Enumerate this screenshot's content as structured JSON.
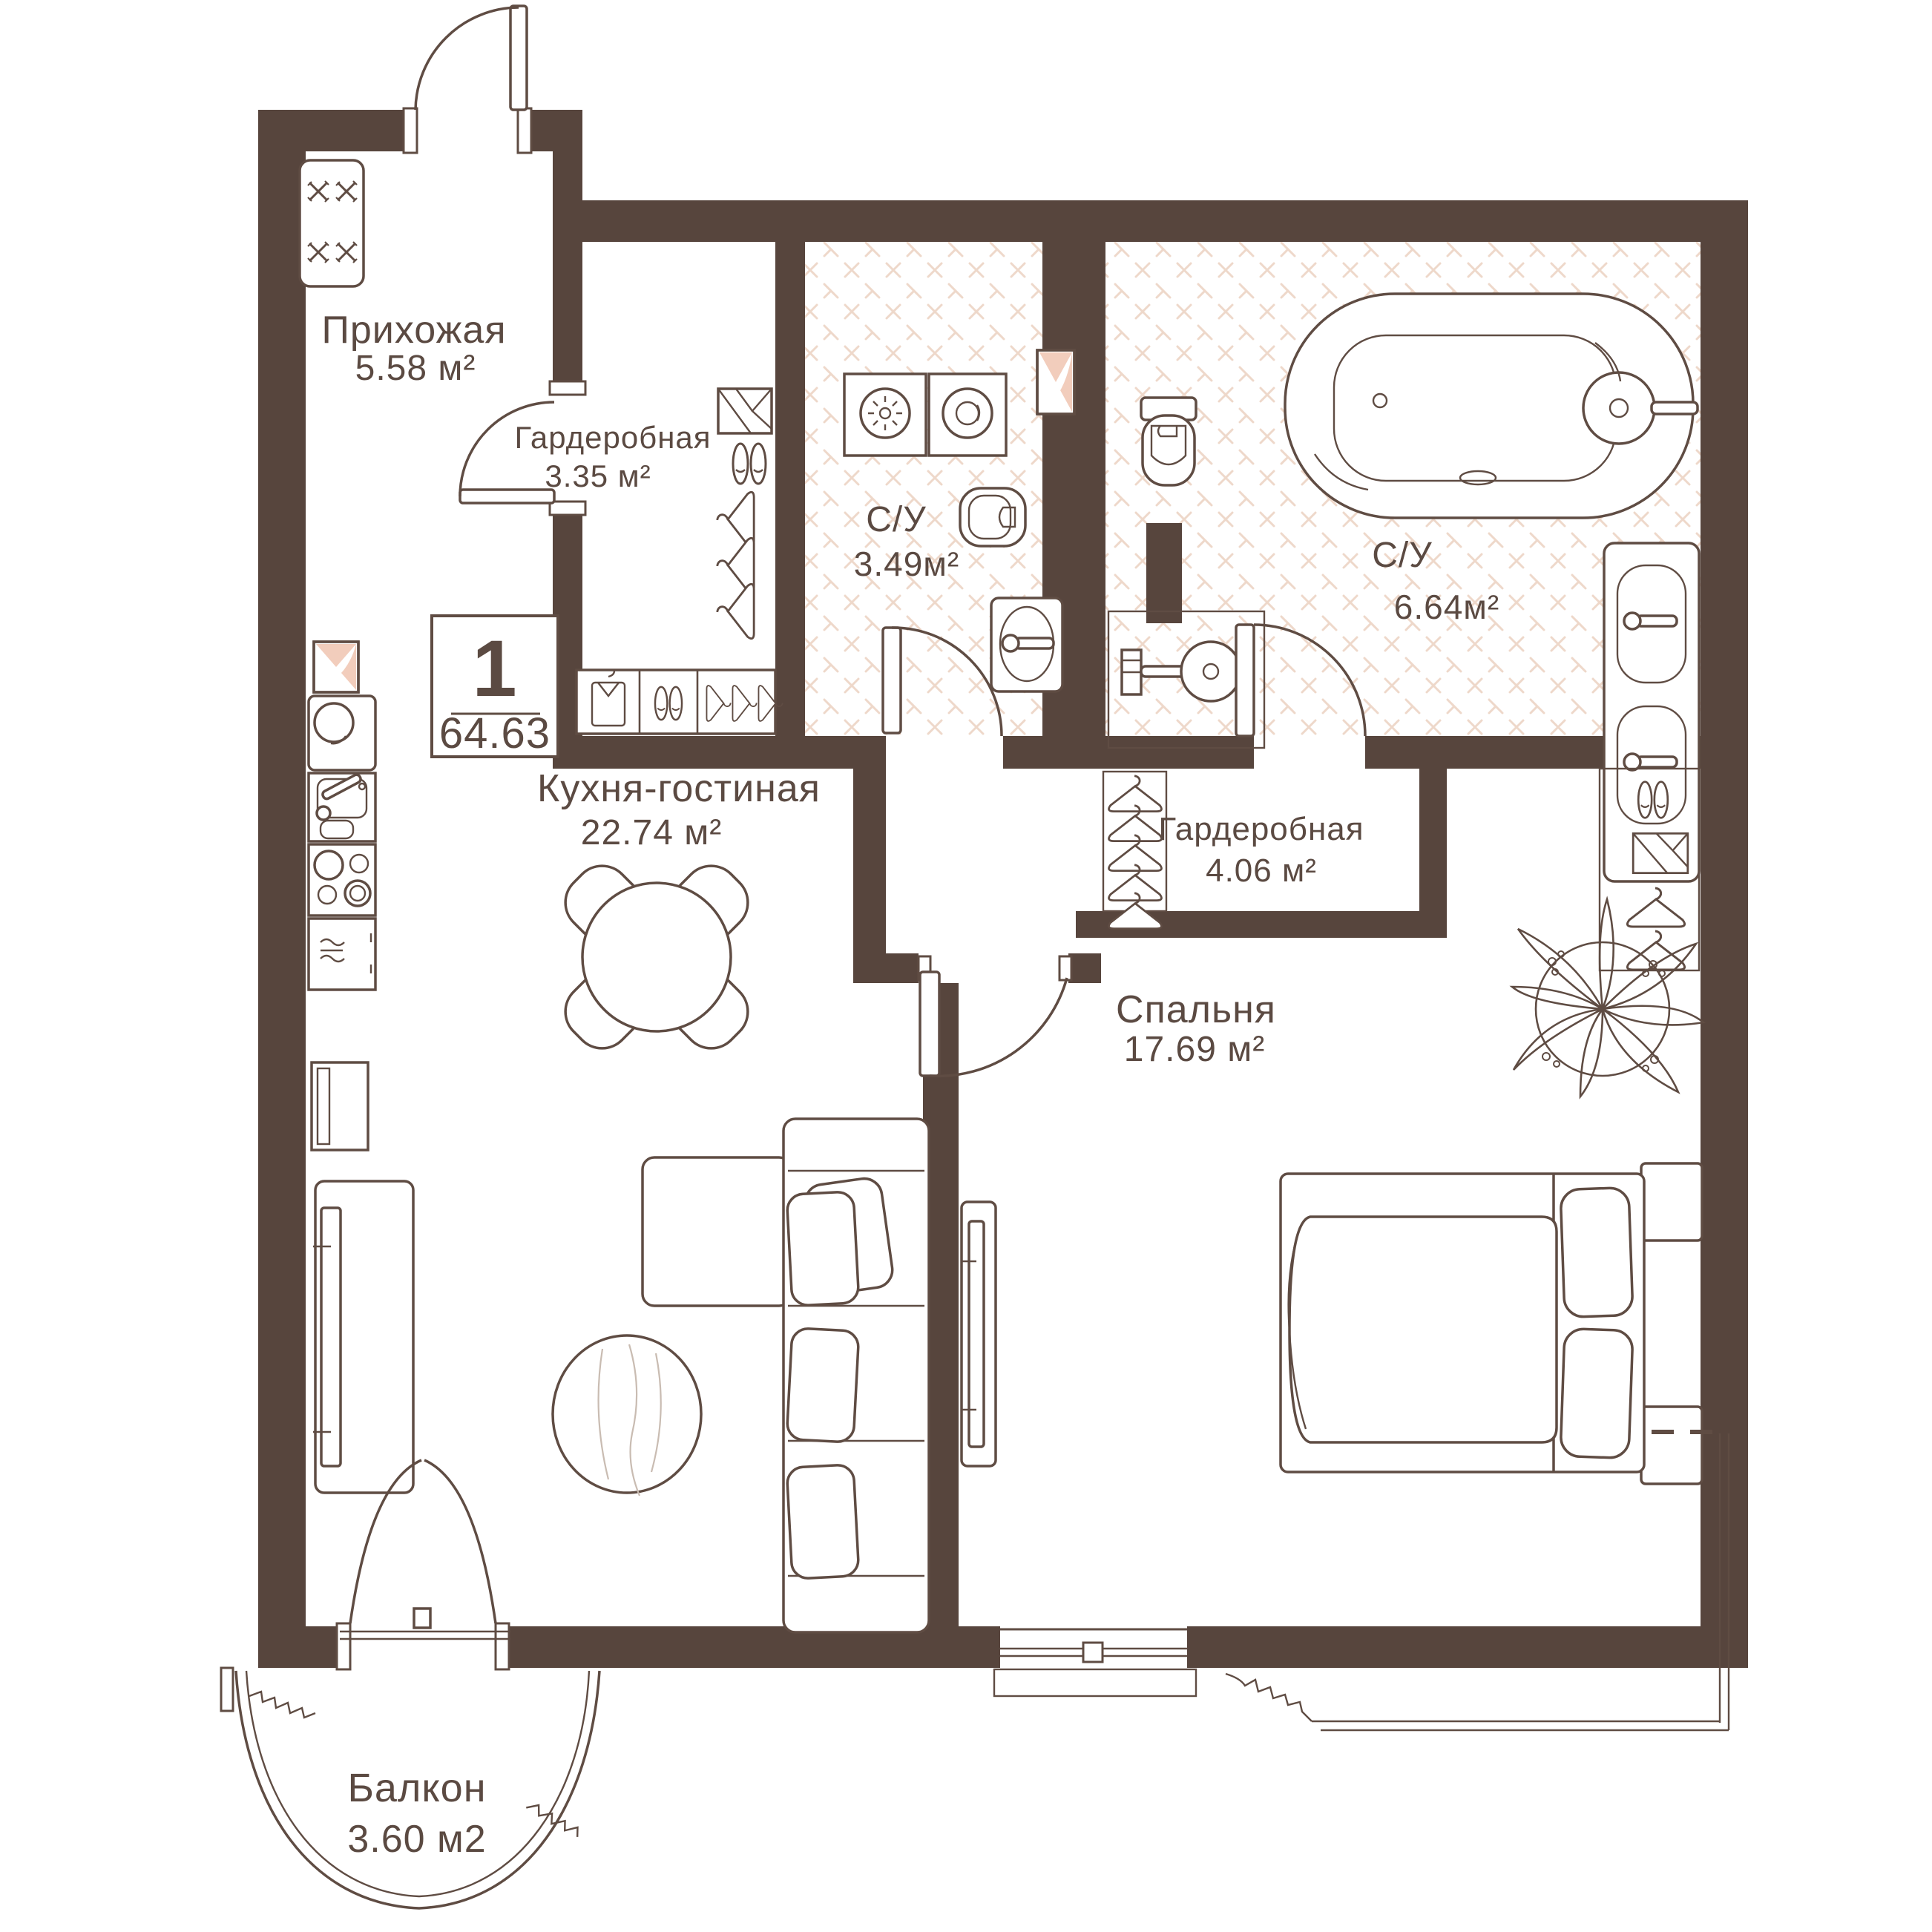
{
  "plan": {
    "badge": {
      "rooms_count": "1",
      "total_area": "64.63"
    },
    "rooms": {
      "hallway": {
        "name": "Прихожая",
        "area": "5.58 м²"
      },
      "wardrobe_small": {
        "name": "Гардеробная",
        "area": "3.35 м²"
      },
      "bathroom_small": {
        "name": "С/У",
        "area": "3.49м²"
      },
      "bathroom_big": {
        "name": "С/У",
        "area": "6.64м²"
      },
      "wardrobe_big": {
        "name": "Гардеробная",
        "area": "4.06 м²"
      },
      "kitchen_living": {
        "name": "Кухня-гостиная",
        "area": "22.74 м²"
      },
      "bedroom": {
        "name": "Спальня",
        "area": "17.69 м²"
      },
      "balcony": {
        "name": "Балкон",
        "area": "3.60 м2"
      }
    },
    "colors": {
      "wall": "#57453d",
      "line": "#5f4c43",
      "tile": "#eed8ca",
      "accent_pink": "#f2cdbc",
      "text": "#5b4a42"
    }
  }
}
